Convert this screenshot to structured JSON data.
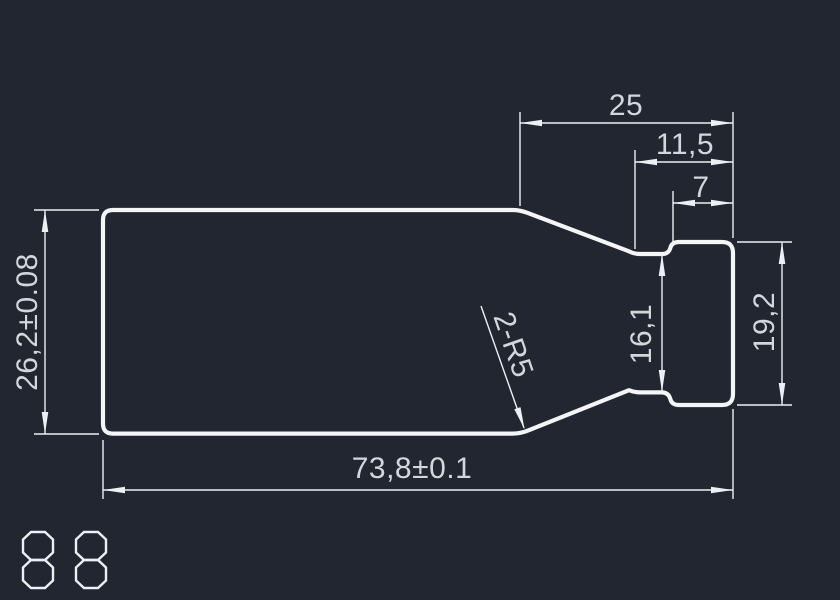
{
  "drawing": {
    "description": "CAD part drawing - stepped bottle-shaped profile with dimensions",
    "dims": {
      "width_25": "25",
      "width_11_5": "11,5",
      "width_7": "7",
      "height_26_2": "26,2±0.08",
      "height_16_1": "16,1",
      "height_19_2": "19,2",
      "length_73_8": "73,8±0.1",
      "radius_leader": "2-R5"
    },
    "stamp": {
      "text": "88"
    }
  },
  "colors": {
    "background": "#212630",
    "outline": "#f3f5f6",
    "dimension_lines": "#edf0f2",
    "dimension_text": "#d2d7dc"
  }
}
